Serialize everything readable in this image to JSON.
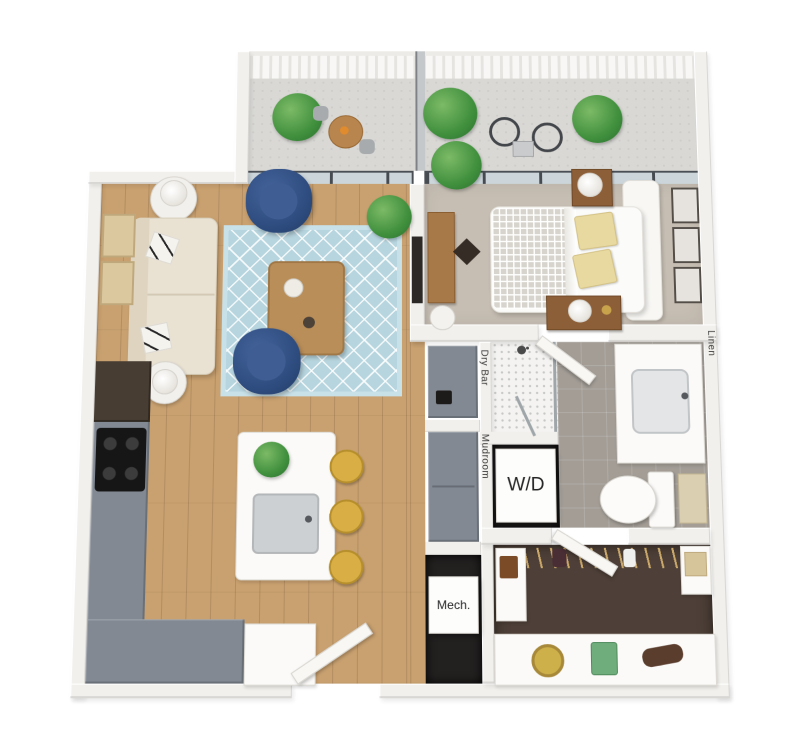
{
  "labels": {
    "dry_bar": "Dry Bar",
    "mudroom": "Mudroom",
    "washer_dryer": "W/D",
    "mechanical": "Mech.",
    "linen": "Linen"
  },
  "colors": {
    "wall": "#f2f0ec",
    "wood_floor": "#c9a170",
    "carpet": "#c6beb3",
    "bath_tile": "#a39d96",
    "closet_floor": "#4e4038",
    "cabinet_gray": "#828993",
    "accent_blue": "#2f4f7d",
    "rug_blue": "#b7d5df",
    "stool_gold": "#d9af45",
    "plant_green": "#4e9b47"
  }
}
